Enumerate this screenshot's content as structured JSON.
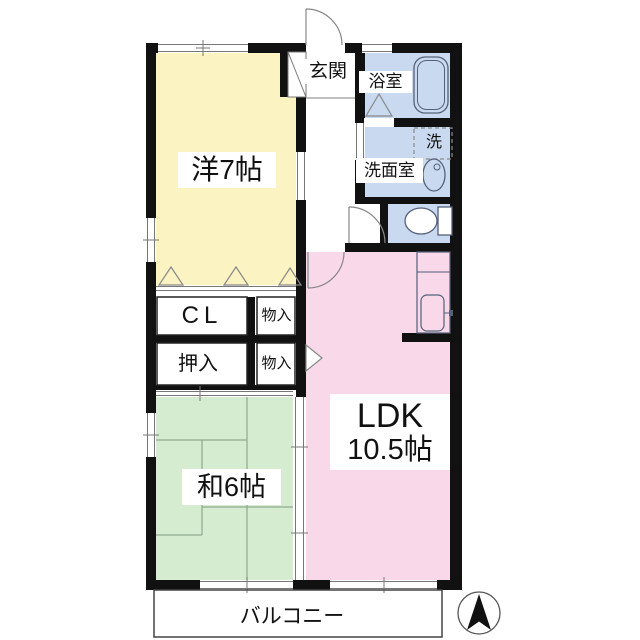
{
  "plan": {
    "type": "floor-plan",
    "rooms": {
      "western_room": {
        "label": "洋7帖",
        "color": "#FBF4C2"
      },
      "japanese_room": {
        "label": "和6帖",
        "color": "#D6ECD0"
      },
      "ldk": {
        "label_line1": "LDK",
        "label_line2": "10.5帖",
        "color": "#F8D8E9"
      },
      "entrance": {
        "label": "玄関"
      },
      "bathroom": {
        "label": "浴室",
        "color": "#C9D9F0"
      },
      "washroom": {
        "label": "洗面室",
        "color": "#C9D9F0"
      },
      "laundry": {
        "label": "洗"
      },
      "toilet": {
        "color": "#C9D9F0"
      },
      "closet_cl": {
        "label": "CL"
      },
      "storage_upper": {
        "label": "物入"
      },
      "oshiire": {
        "label": "押入"
      },
      "storage_lower": {
        "label": "物入"
      },
      "balcony": {
        "label": "バルコニー"
      }
    },
    "colors": {
      "wall": "#111111",
      "thin_line": "#777777",
      "fixture_line": "#55617a",
      "tatami_line": "#90A890"
    },
    "icons": {
      "compass": "north-arrow"
    }
  }
}
